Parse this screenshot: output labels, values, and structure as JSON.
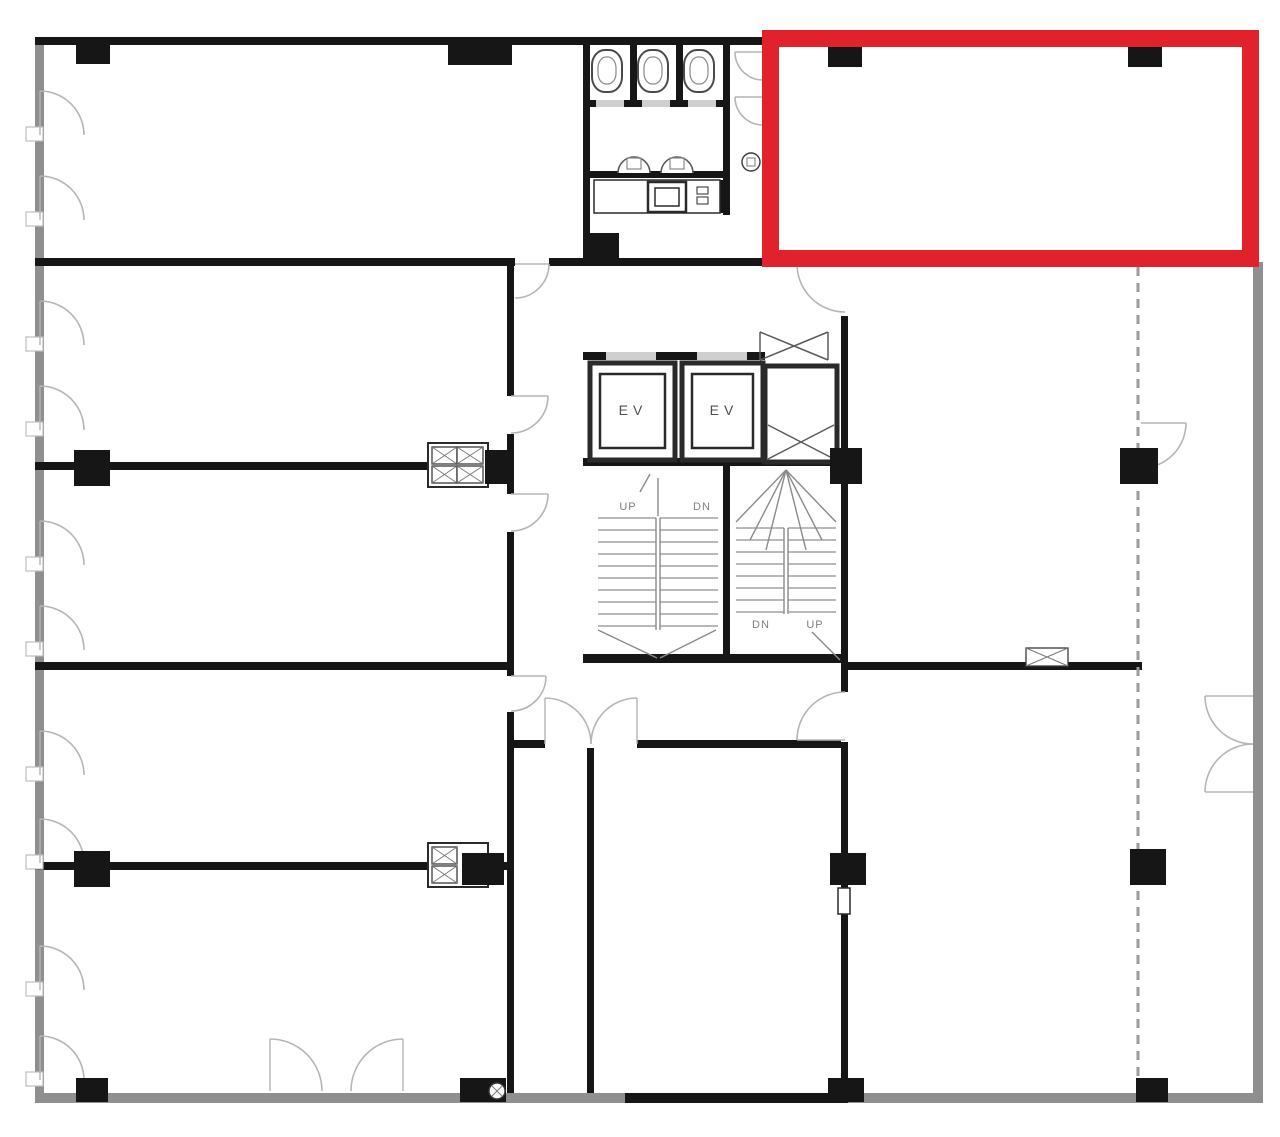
{
  "canvas": {
    "w": 1280,
    "h": 1137,
    "bg": "#ffffff"
  },
  "colors": {
    "wall": "#161616",
    "grayWall": "#8f8f8f",
    "opening": "#ffffff",
    "softOpening": "#cfcfcf",
    "arc": "#b5b5b5",
    "jamb": "#bdbdbd",
    "tread": "#8f8f8f",
    "detail": "#8a8a8a",
    "cross": "#5a5a5a",
    "fixtureStroke": "#2a2a2a",
    "labelEv": "#4f4f4f",
    "labelStair": "#7f7f7f",
    "highlight": "#e2222a",
    "dash": "#9a9a9a"
  },
  "labels": [
    {
      "name": "elevator-1-label",
      "text": "EV",
      "x": 633,
      "y": 415,
      "size": 14,
      "ls": 5,
      "color": "labelEv"
    },
    {
      "name": "elevator-2-label",
      "text": "EV",
      "x": 724,
      "y": 415,
      "size": 14,
      "ls": 5,
      "color": "labelEv"
    },
    {
      "name": "stair-left-up-label",
      "text": "UP",
      "x": 628,
      "y": 510,
      "size": 11,
      "ls": 1,
      "color": "labelStair"
    },
    {
      "name": "stair-left-dn-label",
      "text": "DN",
      "x": 702,
      "y": 510,
      "size": 11,
      "ls": 1,
      "color": "labelStair"
    },
    {
      "name": "stair-right-dn-label",
      "text": "DN",
      "x": 761,
      "y": 628,
      "size": 11,
      "ls": 1,
      "color": "labelStair"
    },
    {
      "name": "stair-right-up-label",
      "text": "UP",
      "x": 815,
      "y": 628,
      "size": 11,
      "ls": 1,
      "color": "labelStair"
    }
  ],
  "plan": {
    "grayWalls": [
      {
        "x": 35,
        "y": 37,
        "w": 9,
        "h": 1066,
        "name": "outer-wall-left"
      },
      {
        "x": 35,
        "y": 1093,
        "w": 1228,
        "h": 10,
        "name": "outer-wall-bottom"
      },
      {
        "x": 1253,
        "y": 262,
        "w": 10,
        "h": 841,
        "name": "outer-wall-right"
      }
    ],
    "walls": [
      {
        "x": 35,
        "y": 37,
        "w": 730,
        "h": 8,
        "name": "outer-wall-top"
      },
      {
        "x": 35,
        "y": 258,
        "w": 813,
        "h": 8
      },
      {
        "x": 35,
        "y": 462,
        "w": 476,
        "h": 8
      },
      {
        "x": 35,
        "y": 662,
        "w": 476,
        "h": 8
      },
      {
        "x": 35,
        "y": 862,
        "w": 476,
        "h": 8
      },
      {
        "x": 507,
        "y": 260,
        "w": 7,
        "h": 833
      },
      {
        "x": 587,
        "y": 745,
        "w": 7,
        "h": 348
      },
      {
        "x": 507,
        "y": 740,
        "w": 341,
        "h": 8
      },
      {
        "x": 841,
        "y": 258,
        "w": 7,
        "h": 835
      },
      {
        "x": 845,
        "y": 662,
        "w": 297,
        "h": 8
      },
      {
        "x": 583,
        "y": 654,
        "w": 265,
        "h": 9
      },
      {
        "x": 583,
        "y": 37,
        "w": 7,
        "h": 223
      },
      {
        "x": 723,
        "y": 37,
        "w": 7,
        "h": 178
      },
      {
        "x": 630,
        "y": 37,
        "w": 7,
        "h": 67
      },
      {
        "x": 676,
        "y": 37,
        "w": 7,
        "h": 67
      },
      {
        "x": 583,
        "y": 100,
        "w": 147,
        "h": 7
      },
      {
        "x": 583,
        "y": 171,
        "w": 147,
        "h": 7
      },
      {
        "x": 583,
        "y": 352,
        "w": 182,
        "h": 8
      },
      {
        "x": 583,
        "y": 458,
        "w": 265,
        "h": 8
      },
      {
        "x": 723,
        "y": 466,
        "w": 7,
        "h": 196
      },
      {
        "x": 625,
        "y": 1093,
        "w": 223,
        "h": 10
      },
      {
        "x": 716,
        "y": 180,
        "w": 7,
        "h": 33
      },
      {
        "x": 765,
        "y": 416,
        "w": 72,
        "h": 6
      }
    ],
    "gaps": [
      {
        "x": 515,
        "y": 258,
        "w": 34,
        "h": 8
      },
      {
        "x": 507,
        "y": 396,
        "w": 7,
        "h": 38
      },
      {
        "x": 507,
        "y": 494,
        "w": 7,
        "h": 38
      },
      {
        "x": 507,
        "y": 676,
        "w": 7,
        "h": 36
      },
      {
        "x": 841,
        "y": 266,
        "w": 7,
        "h": 50
      },
      {
        "x": 841,
        "y": 692,
        "w": 7,
        "h": 50
      },
      {
        "x": 545,
        "y": 740,
        "w": 92,
        "h": 8
      },
      {
        "x": 606,
        "y": 352,
        "w": 50,
        "h": 8,
        "soft": true
      },
      {
        "x": 697,
        "y": 352,
        "w": 50,
        "h": 8,
        "soft": true
      },
      {
        "x": 596,
        "y": 100,
        "w": 28,
        "h": 7,
        "soft": true
      },
      {
        "x": 642,
        "y": 100,
        "w": 28,
        "h": 7,
        "soft": true
      },
      {
        "x": 688,
        "y": 100,
        "w": 28,
        "h": 7,
        "soft": true
      }
    ],
    "dashedWalls": [
      {
        "x": 1138,
        "y1": 267,
        "y2": 1093,
        "name": "dashed-partition-wall"
      }
    ],
    "columns": [
      {
        "x": 76,
        "y": 37,
        "w": 34,
        "h": 27
      },
      {
        "x": 448,
        "y": 37,
        "w": 64,
        "h": 28,
        "name": "fire-box-housing"
      },
      {
        "x": 828,
        "y": 47,
        "w": 34,
        "h": 20
      },
      {
        "x": 1128,
        "y": 47,
        "w": 34,
        "h": 20
      },
      {
        "x": 74,
        "y": 450,
        "w": 36,
        "h": 36
      },
      {
        "x": 485,
        "y": 450,
        "w": 26,
        "h": 34
      },
      {
        "x": 830,
        "y": 448,
        "w": 32,
        "h": 36
      },
      {
        "x": 1120,
        "y": 448,
        "w": 38,
        "h": 36
      },
      {
        "x": 74,
        "y": 851,
        "w": 36,
        "h": 36
      },
      {
        "x": 462,
        "y": 853,
        "w": 42,
        "h": 32
      },
      {
        "x": 830,
        "y": 853,
        "w": 36,
        "h": 32
      },
      {
        "x": 1130,
        "y": 849,
        "w": 36,
        "h": 36
      },
      {
        "x": 76,
        "y": 1078,
        "w": 32,
        "h": 24
      },
      {
        "x": 460,
        "y": 1078,
        "w": 46,
        "h": 24
      },
      {
        "x": 828,
        "y": 1078,
        "w": 36,
        "h": 24
      },
      {
        "x": 1136,
        "y": 1078,
        "w": 32,
        "h": 24
      },
      {
        "x": 583,
        "y": 233,
        "w": 36,
        "h": 30,
        "name": "meter-housing"
      }
    ],
    "openBoxes": [
      {
        "x": 590,
        "y": 363,
        "w": 85,
        "h": 97,
        "sw": 5,
        "name": "elevator-1-shaft"
      },
      {
        "x": 600,
        "y": 374,
        "w": 65,
        "h": 74,
        "sw": 2.5,
        "name": "elevator-1-car"
      },
      {
        "x": 682,
        "y": 363,
        "w": 81,
        "h": 97,
        "sw": 5,
        "name": "elevator-2-shaft"
      },
      {
        "x": 692,
        "y": 374,
        "w": 61,
        "h": 74,
        "sw": 2.5,
        "name": "elevator-2-car"
      },
      {
        "x": 765,
        "y": 366,
        "w": 72,
        "h": 96,
        "sw": 5,
        "name": "service-shaft"
      },
      {
        "x": 428,
        "y": 443,
        "w": 60,
        "h": 44,
        "sw": 2,
        "name": "duct-fixture"
      },
      {
        "x": 428,
        "y": 843,
        "w": 60,
        "h": 44,
        "sw": 2,
        "name": "duct-fixture"
      },
      {
        "x": 594,
        "y": 180,
        "w": 126,
        "h": 33,
        "sw": 1.5,
        "name": "kitchenette-counter"
      },
      {
        "x": 648,
        "y": 182,
        "w": 38,
        "h": 30,
        "sw": 2.5,
        "name": "counter-sink"
      },
      {
        "x": 655,
        "y": 188,
        "w": 24,
        "h": 18,
        "sw": 1.5,
        "name": "counter-sink-basin"
      },
      {
        "x": 697,
        "y": 187,
        "w": 11,
        "h": 7,
        "sw": 1,
        "name": "counter-fixture"
      },
      {
        "x": 697,
        "y": 197,
        "w": 11,
        "h": 7,
        "sw": 1,
        "name": "counter-fixture"
      },
      {
        "x": 838,
        "y": 888,
        "w": 12,
        "h": 26,
        "sw": 1.5,
        "name": "wall-fixture"
      }
    ],
    "xBoxes": [
      {
        "x": 454,
        "y": 42,
        "w": 34,
        "h": 17,
        "name": "fire-hose-box"
      },
      {
        "x": 432,
        "y": 447,
        "w": 25,
        "h": 17
      },
      {
        "x": 432,
        "y": 466,
        "w": 25,
        "h": 17
      },
      {
        "x": 457,
        "y": 447,
        "w": 26,
        "h": 17
      },
      {
        "x": 457,
        "y": 466,
        "w": 26,
        "h": 17
      },
      {
        "x": 432,
        "y": 847,
        "w": 25,
        "h": 17
      },
      {
        "x": 432,
        "y": 866,
        "w": 25,
        "h": 17
      },
      {
        "x": 1026,
        "y": 648,
        "w": 42,
        "h": 18,
        "name": "vent-box"
      },
      {
        "x": 589,
        "y": 238,
        "w": 24,
        "h": 20,
        "name": "meter-box"
      }
    ],
    "crossLines": [
      {
        "x1": 768,
        "y1": 425,
        "x2": 834,
        "y2": 459
      },
      {
        "x1": 768,
        "y1": 459,
        "x2": 834,
        "y2": 425
      },
      {
        "x1": 760,
        "y1": 332,
        "x2": 828,
        "y2": 360
      },
      {
        "x1": 760,
        "y1": 360,
        "x2": 828,
        "y2": 332
      },
      {
        "x1": 760,
        "y1": 332,
        "x2": 760,
        "y2": 360
      },
      {
        "x1": 828,
        "y1": 332,
        "x2": 828,
        "y2": 360
      }
    ],
    "doorArcs": [
      {
        "cx": 40,
        "cy": 135,
        "r": 44,
        "from": "N",
        "to": "E",
        "sweep": 1
      },
      {
        "cx": 40,
        "cy": 220,
        "r": 44,
        "from": "N",
        "to": "E",
        "sweep": 1
      },
      {
        "cx": 40,
        "cy": 345,
        "r": 44,
        "from": "N",
        "to": "E",
        "sweep": 1
      },
      {
        "cx": 40,
        "cy": 430,
        "r": 44,
        "from": "N",
        "to": "E",
        "sweep": 1
      },
      {
        "cx": 40,
        "cy": 565,
        "r": 44,
        "from": "N",
        "to": "E",
        "sweep": 1
      },
      {
        "cx": 40,
        "cy": 650,
        "r": 44,
        "from": "N",
        "to": "E",
        "sweep": 1
      },
      {
        "cx": 40,
        "cy": 775,
        "r": 44,
        "from": "N",
        "to": "E",
        "sweep": 1
      },
      {
        "cx": 40,
        "cy": 863,
        "r": 44,
        "from": "N",
        "to": "E",
        "sweep": 1
      },
      {
        "cx": 40,
        "cy": 990,
        "r": 44,
        "from": "N",
        "to": "E",
        "sweep": 1
      },
      {
        "cx": 40,
        "cy": 1080,
        "r": 44,
        "from": "N",
        "to": "E",
        "sweep": 1
      },
      {
        "cx": 515,
        "cy": 264,
        "r": 34,
        "from": "E",
        "to": "S",
        "sweep": 1
      },
      {
        "cx": 511,
        "cy": 396,
        "r": 37,
        "from": "E",
        "to": "S",
        "sweep": 1
      },
      {
        "cx": 511,
        "cy": 494,
        "r": 37,
        "from": "E",
        "to": "S",
        "sweep": 1
      },
      {
        "cx": 511,
        "cy": 676,
        "r": 35,
        "from": "E",
        "to": "S",
        "sweep": 1
      },
      {
        "cx": 845,
        "cy": 264,
        "r": 48,
        "from": "W",
        "to": "S",
        "sweep": 0
      },
      {
        "cx": 845,
        "cy": 740,
        "r": 48,
        "from": "W",
        "to": "N",
        "sweep": 1
      },
      {
        "cx": 545,
        "cy": 744,
        "r": 46,
        "from": "N",
        "to": "E",
        "sweep": 1
      },
      {
        "cx": 637,
        "cy": 744,
        "r": 46,
        "from": "N",
        "to": "W",
        "sweep": 0
      },
      {
        "cx": 270,
        "cy": 1091,
        "r": 52,
        "from": "N",
        "to": "E",
        "sweep": 1
      },
      {
        "cx": 403,
        "cy": 1091,
        "r": 52,
        "from": "N",
        "to": "W",
        "sweep": 0
      },
      {
        "cx": 1141,
        "cy": 423,
        "r": 45,
        "from": "E",
        "to": "S",
        "sweep": 1
      },
      {
        "cx": 1253,
        "cy": 696,
        "r": 48,
        "from": "W",
        "to": "S",
        "sweep": 0
      },
      {
        "cx": 1253,
        "cy": 792,
        "r": 48,
        "from": "W",
        "to": "N",
        "sweep": 1
      },
      {
        "cx": 763,
        "cy": 52,
        "r": 28,
        "from": "W",
        "to": "S",
        "sweep": 0
      },
      {
        "cx": 763,
        "cy": 97,
        "r": 28,
        "from": "W",
        "to": "S",
        "sweep": 0
      }
    ],
    "jambs": [
      {
        "x": 26,
        "y": 127,
        "w": 17,
        "h": 14
      },
      {
        "x": 26,
        "y": 212,
        "w": 17,
        "h": 14
      },
      {
        "x": 26,
        "y": 337,
        "w": 17,
        "h": 14
      },
      {
        "x": 26,
        "y": 422,
        "w": 17,
        "h": 14
      },
      {
        "x": 26,
        "y": 557,
        "w": 17,
        "h": 14
      },
      {
        "x": 26,
        "y": 642,
        "w": 17,
        "h": 14
      },
      {
        "x": 26,
        "y": 767,
        "w": 17,
        "h": 14
      },
      {
        "x": 26,
        "y": 855,
        "w": 17,
        "h": 14
      },
      {
        "x": 26,
        "y": 982,
        "w": 17,
        "h": 14
      },
      {
        "x": 26,
        "y": 1072,
        "w": 17,
        "h": 14
      }
    ],
    "circles": [
      {
        "cx": 751,
        "cy": 162,
        "r": 9,
        "sq": true,
        "name": "cleanout-fixture"
      },
      {
        "cx": 497,
        "cy": 1091,
        "r": 8,
        "xm": true,
        "name": "floor-drain"
      }
    ],
    "toilets": [
      {
        "cx": 607
      },
      {
        "cx": 653
      },
      {
        "cx": 699
      }
    ],
    "sinks": [
      {
        "cx": 634,
        "cy": 173,
        "r": 16
      },
      {
        "cx": 677,
        "cy": 173,
        "r": 16
      }
    ],
    "treadGroups": [
      {
        "x": 598,
        "y": 518,
        "w": 58,
        "rows": 10,
        "gap": 12
      },
      {
        "x": 660,
        "y": 518,
        "w": 58,
        "rows": 10,
        "gap": 12
      },
      {
        "x": 736,
        "y": 528,
        "w": 48,
        "rows": 8,
        "gap": 12
      },
      {
        "x": 788,
        "y": 528,
        "w": 48,
        "rows": 8,
        "gap": 12
      }
    ],
    "lines": [
      {
        "x1": 656,
        "y1": 518,
        "x2": 656,
        "y2": 630
      },
      {
        "x1": 660,
        "y1": 518,
        "x2": 660,
        "y2": 630
      },
      {
        "x1": 598,
        "y1": 630,
        "x2": 657,
        "y2": 658
      },
      {
        "x1": 716,
        "y1": 630,
        "x2": 660,
        "y2": 658
      },
      {
        "x1": 658,
        "y1": 478,
        "x2": 658,
        "y2": 516
      },
      {
        "x1": 640,
        "y1": 492,
        "x2": 650,
        "y2": 474
      },
      {
        "x1": 786,
        "y1": 470,
        "x2": 736,
        "y2": 522
      },
      {
        "x1": 786,
        "y1": 470,
        "x2": 750,
        "y2": 540
      },
      {
        "x1": 786,
        "y1": 470,
        "x2": 766,
        "y2": 550
      },
      {
        "x1": 786,
        "y1": 470,
        "x2": 836,
        "y2": 522
      },
      {
        "x1": 786,
        "y1": 470,
        "x2": 822,
        "y2": 540
      },
      {
        "x1": 786,
        "y1": 470,
        "x2": 806,
        "y2": 550
      },
      {
        "x1": 784,
        "y1": 528,
        "x2": 784,
        "y2": 614
      },
      {
        "x1": 788,
        "y1": 528,
        "x2": 788,
        "y2": 614
      },
      {
        "x1": 812,
        "y1": 632,
        "x2": 840,
        "y2": 660
      }
    ]
  },
  "highlight": {
    "x": 770.5,
    "y": 38.5,
    "w": 480,
    "h": 220,
    "sw": 17,
    "name": "highlight-rectangle"
  }
}
